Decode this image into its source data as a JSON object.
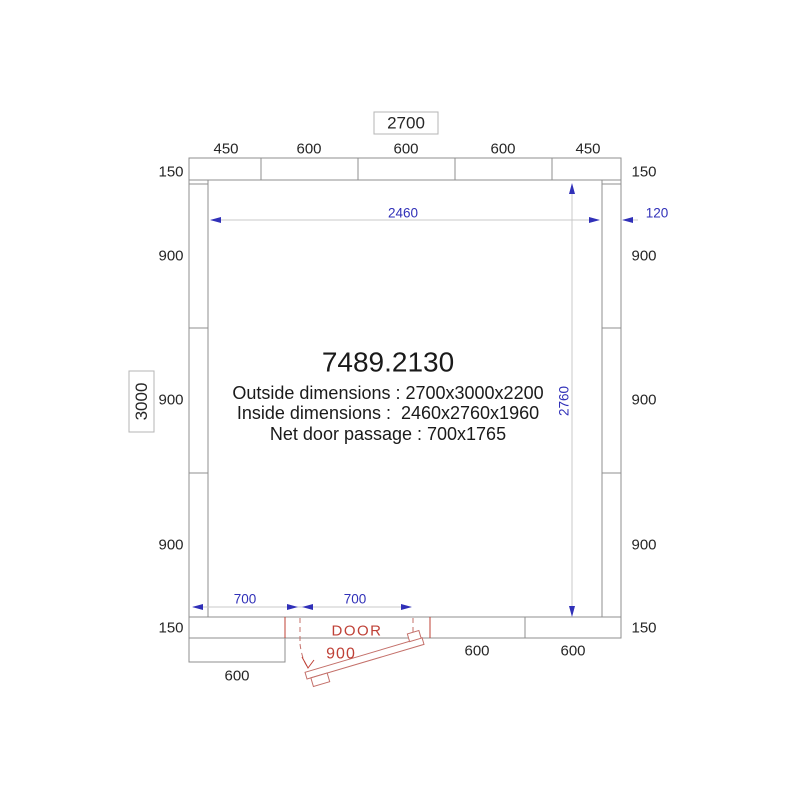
{
  "drawing": {
    "product_code": "7489.2130",
    "outside_dimensions": "Outside dimensions : 2700x3000x2200",
    "inside_dimensions": "Inside dimensions :  2460x2760x1960",
    "net_door_passage": "Net door passage : 700x1765"
  },
  "overall": {
    "width_label": "2700",
    "depth_label": "3000"
  },
  "panels": {
    "top": [
      "450",
      "600",
      "600",
      "600",
      "450"
    ],
    "left": [
      "150",
      "900",
      "900",
      "900",
      "150"
    ],
    "right": [
      "150",
      "900",
      "900",
      "900",
      "150"
    ],
    "bottom": [
      "600",
      "600",
      "600"
    ]
  },
  "inner_dimensions": {
    "width": "2460",
    "depth": "2760",
    "wall_thickness": "120"
  },
  "door": {
    "label": "DOOR",
    "frame_width": "900",
    "offset_left": "700",
    "net_passage": "700"
  },
  "colors": {
    "dimension_blue": "#3030b8",
    "door_red": "#bf4036",
    "wall_gray": "#8f8f8f"
  }
}
